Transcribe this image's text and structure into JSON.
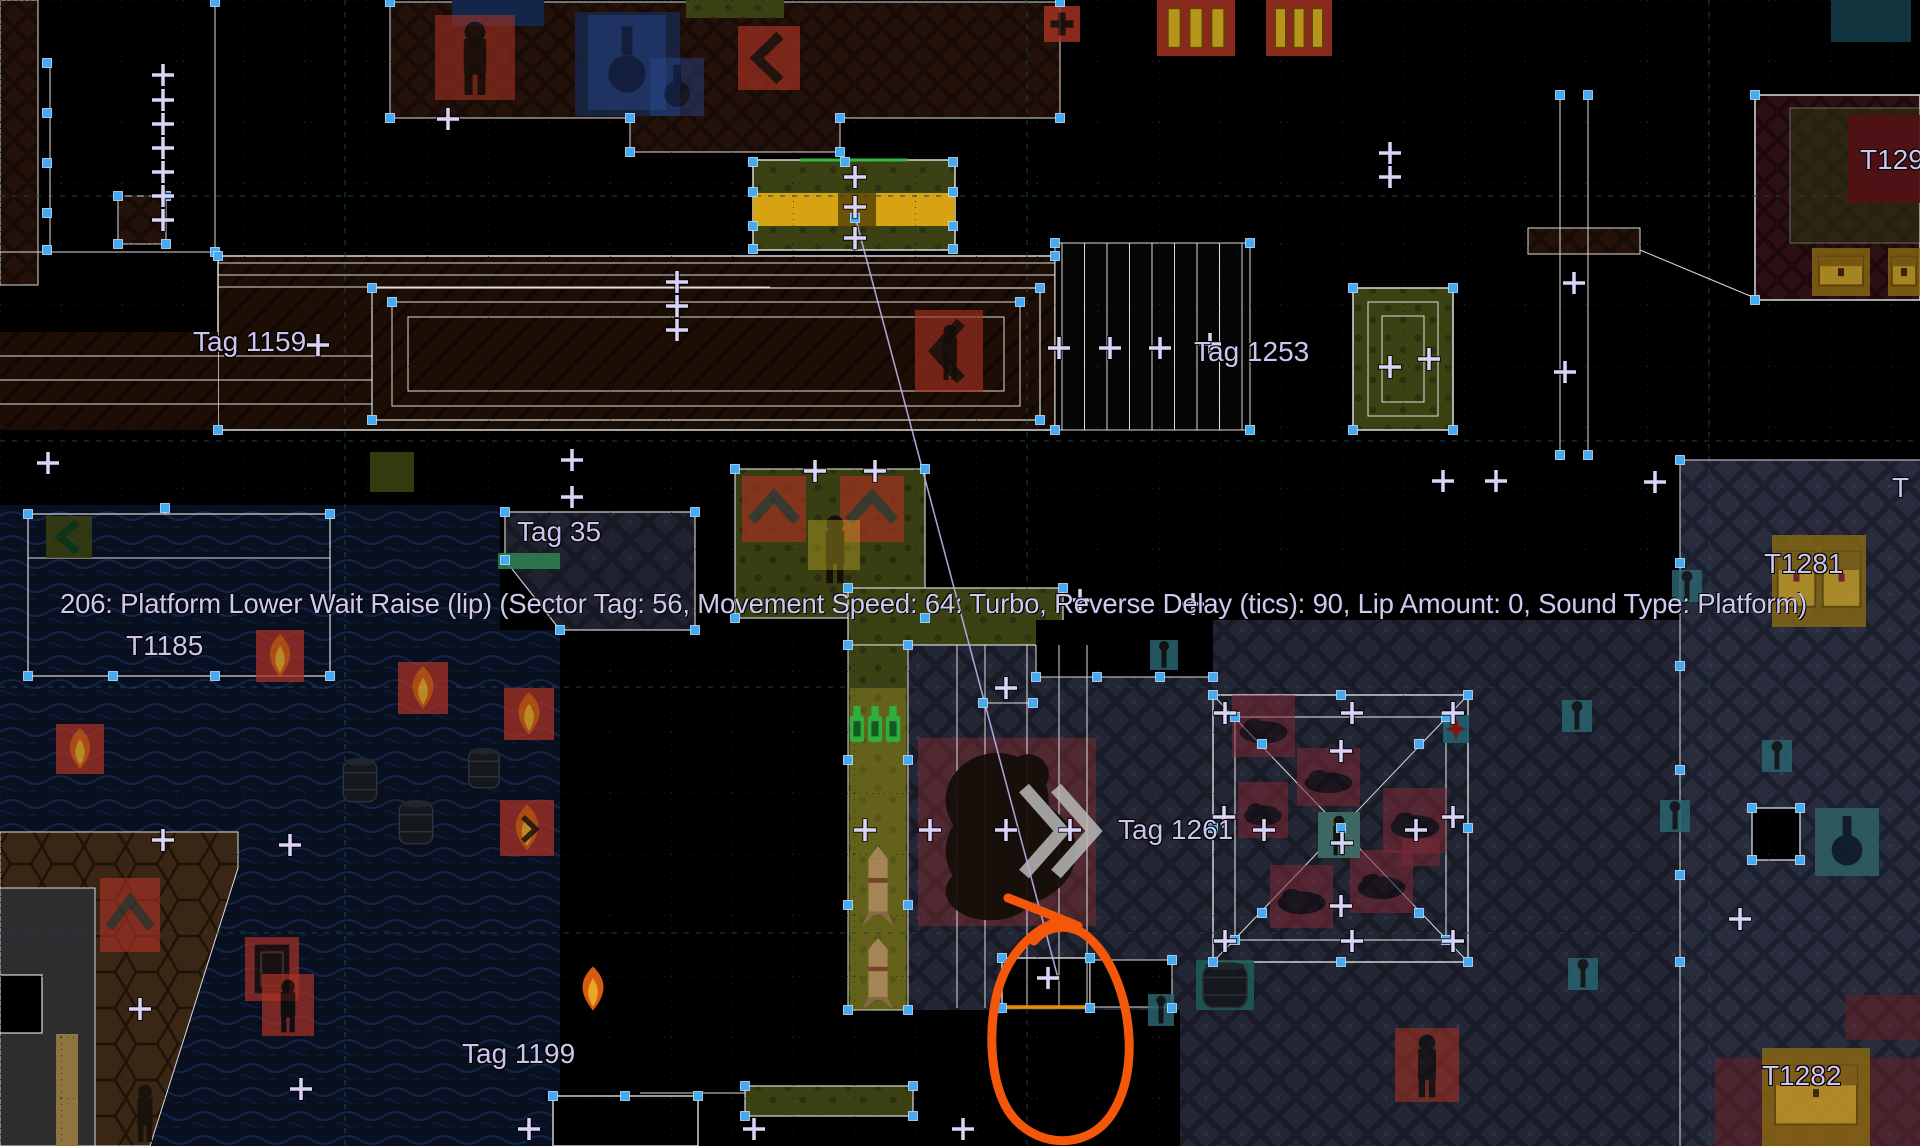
{
  "editor": {
    "info_line": "206: Platform Lower Wait Raise (lip) (Sector Tag: 56, Movement Speed: 64: Turbo, Reverse Delay (tics): 90, Lip Amount: 0, Sound Type: Platform)"
  },
  "labels": {
    "tag_1159": "Tag 1159",
    "tag_1253": "Tag 1253",
    "tag_35": "Tag 35",
    "t1185": "T1185",
    "t1281": "T1281",
    "tag_1261": "Tag 1261",
    "tag_1199": "Tag 1199",
    "t1282": "T1282",
    "t129_clipped": "T129",
    "t_clipped": "T"
  },
  "colors": {
    "background": "#000000",
    "linedef": "#dcdcdc",
    "vertex": "#46aaf2",
    "thing_marker": "#d9d4f8",
    "label_text": "#cdc5ef",
    "info_text": "#cfc8f2",
    "highlight_linedef": "#e09000",
    "tag_association_line": "#b6b2e8",
    "annotation_orange": "#f4560a",
    "grid": "#14222e",
    "grid_accent": "#1c4250",
    "platform_yellow": "#d8a312",
    "sector_green_edge": "#39b54a"
  },
  "icons": {
    "vertex-icon": "square",
    "thing-marker-icon": "plus",
    "torch-icon": "flame",
    "barrel-icon": "barrel",
    "chest-icon": "chest",
    "potion-icon": "flask",
    "soldier-icon": "humanoid",
    "arrow-icon": "chevron",
    "monster-icon": "silhouette",
    "key-icon": "key",
    "annotation-icon": "freehand-circle"
  }
}
